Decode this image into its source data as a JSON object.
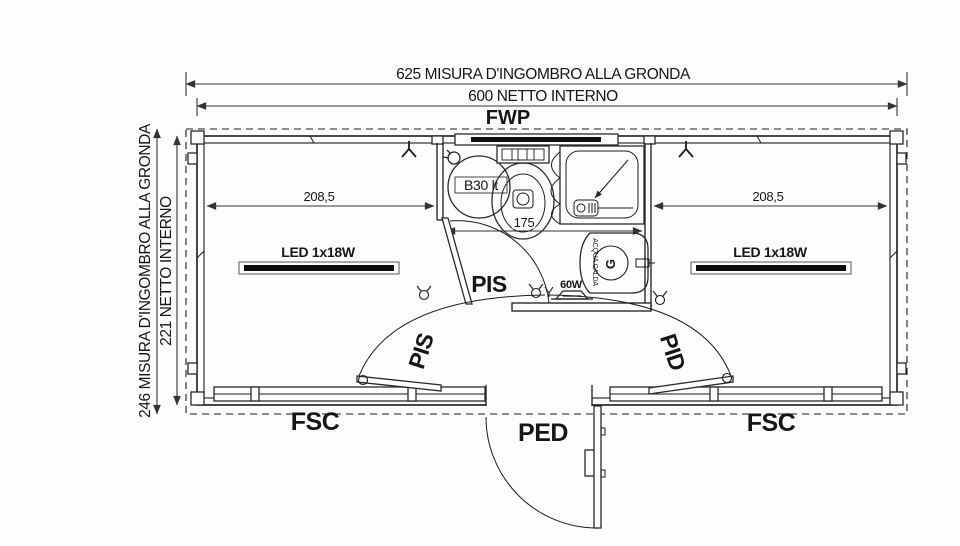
{
  "drawing": {
    "dimensions": {
      "top_outer": "625 MISURA D'INGOMBRO ALLA GRONDA",
      "top_inner": "600 NETTO INTERNO",
      "side_outer": "246 MISURA D'INGOMBRO ALLA GRONDA",
      "side_inner": "221 NETTO INTERNO",
      "left_room_width": "208,5",
      "right_room_width": "208,5",
      "bathroom_width": "175"
    },
    "openings": {
      "top_window": "FWP",
      "left_window": "FSC",
      "right_window": "FSC",
      "entry_door": "PED",
      "bathroom_door": "PIS",
      "left_room_door": "PIS",
      "right_room_door": "PID"
    },
    "fixtures": {
      "boiler": "B30 lt",
      "left_light": "LED 1x18W",
      "right_light": "LED 1x18W",
      "wall_lamp": "60W",
      "hot_water_note": "ACQUA CALDA",
      "basin_mark": "G"
    },
    "colors": {
      "ink": "#1c1c1c",
      "paper": "#fdfdfd"
    }
  }
}
